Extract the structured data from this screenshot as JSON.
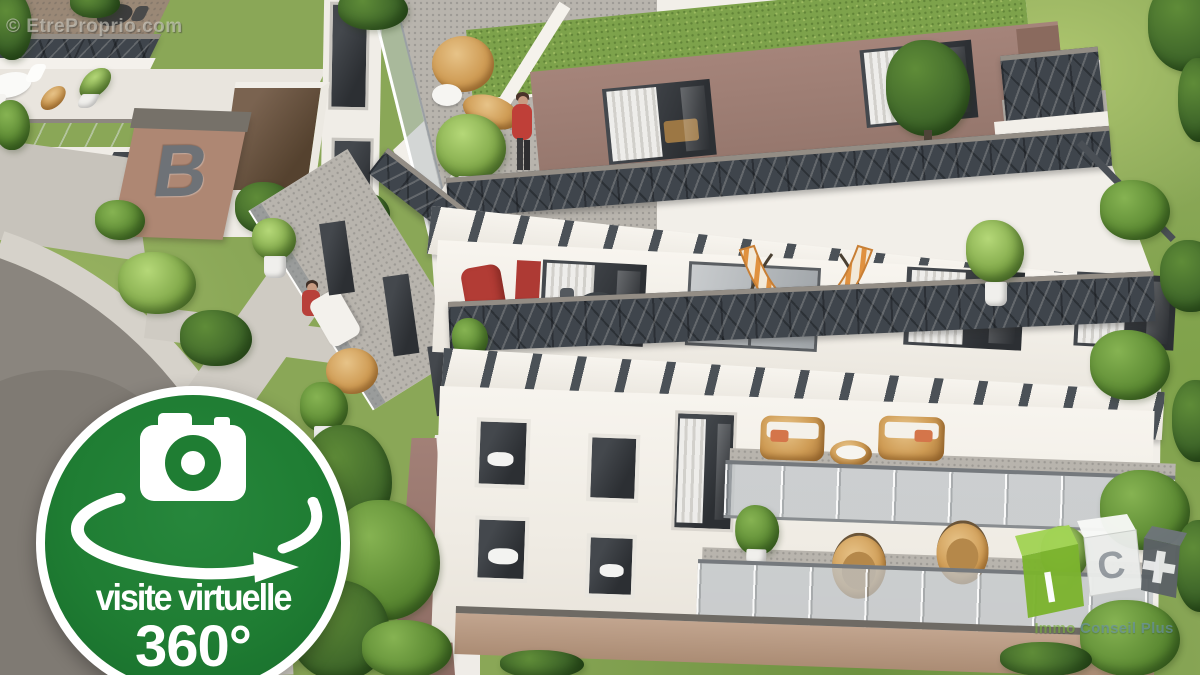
{
  "watermark": {
    "text": "© EtreProprio.com"
  },
  "badge": {
    "title": "visite virtuelle",
    "subtitle": "360°",
    "background_color": "#1f7d33",
    "ring_color": "#ffffff"
  },
  "building_sign": {
    "label": "B"
  },
  "logo": {
    "cubes": [
      {
        "letter": "I",
        "color": "#7cb42e"
      },
      {
        "letter": "C",
        "color": "#ebedeb"
      },
      {
        "letter": "+",
        "color": "#5c6266"
      }
    ],
    "brand_part1": "Immo",
    "brand_part2": "Conseil Plus",
    "brand_color_1": "#7daf42",
    "brand_color_2": "#6991b0"
  }
}
